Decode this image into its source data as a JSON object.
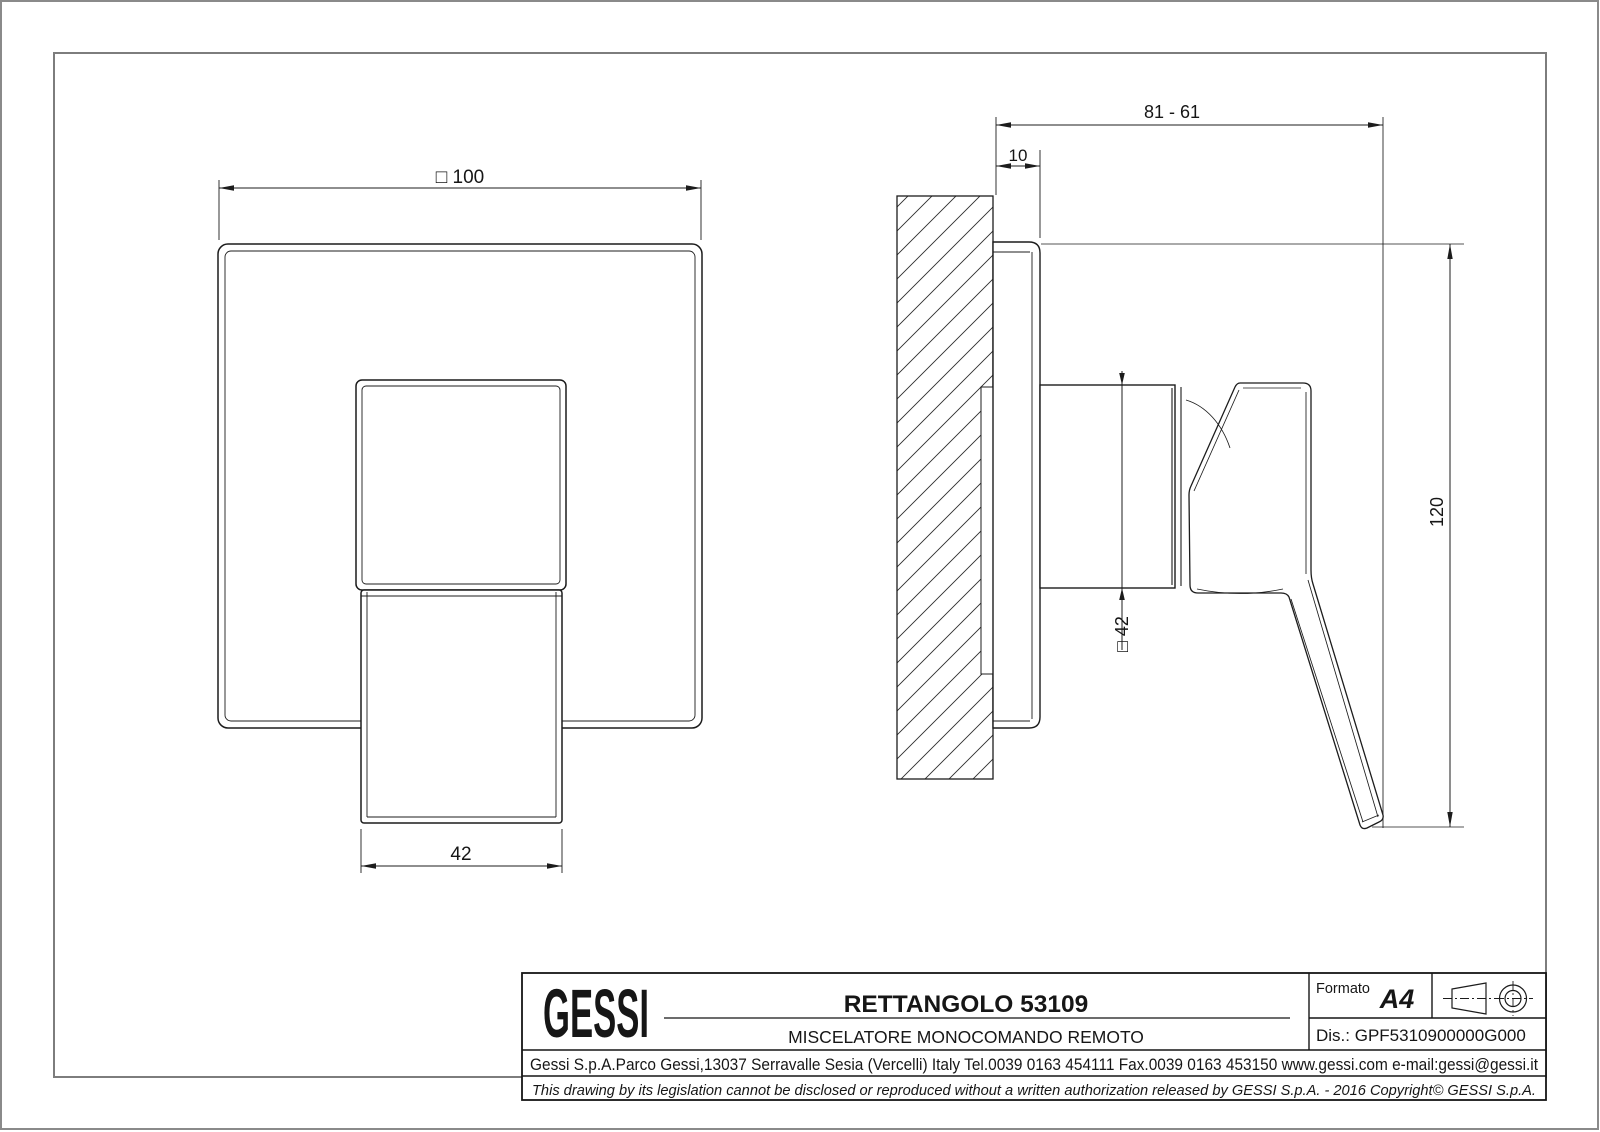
{
  "colors": {
    "line": "#1c1c1c",
    "frame": "#7d7d7d",
    "paper": "#ffffff"
  },
  "dims": {
    "plate_width": "□ 100",
    "lever_width": "42",
    "depth_range": "81 - 61",
    "plate_depth": "10",
    "overall_height": "120",
    "body_square": "□ 42"
  },
  "title_block": {
    "logo": "GESSI",
    "product_title": "RETTANGOLO 53109",
    "product_subtitle": "MISCELATORE MONOCOMANDO REMOTO",
    "format_label": "Formato",
    "format_value": "A4",
    "drawing_number": "Dis.: GPF5310900000G000",
    "address": "Gessi S.p.A.Parco Gessi,13037 Serravalle Sesia (Vercelli) Italy Tel.0039 0163 454111 Fax.0039 0163 453150 www.gessi.com e-mail:gessi@gessi.it",
    "disclaimer": "This drawing by its legislation cannot be disclosed or reproduced without a written authorization released by GESSI S.p.A. - 2016 Copyright© GESSI S.p.A."
  }
}
